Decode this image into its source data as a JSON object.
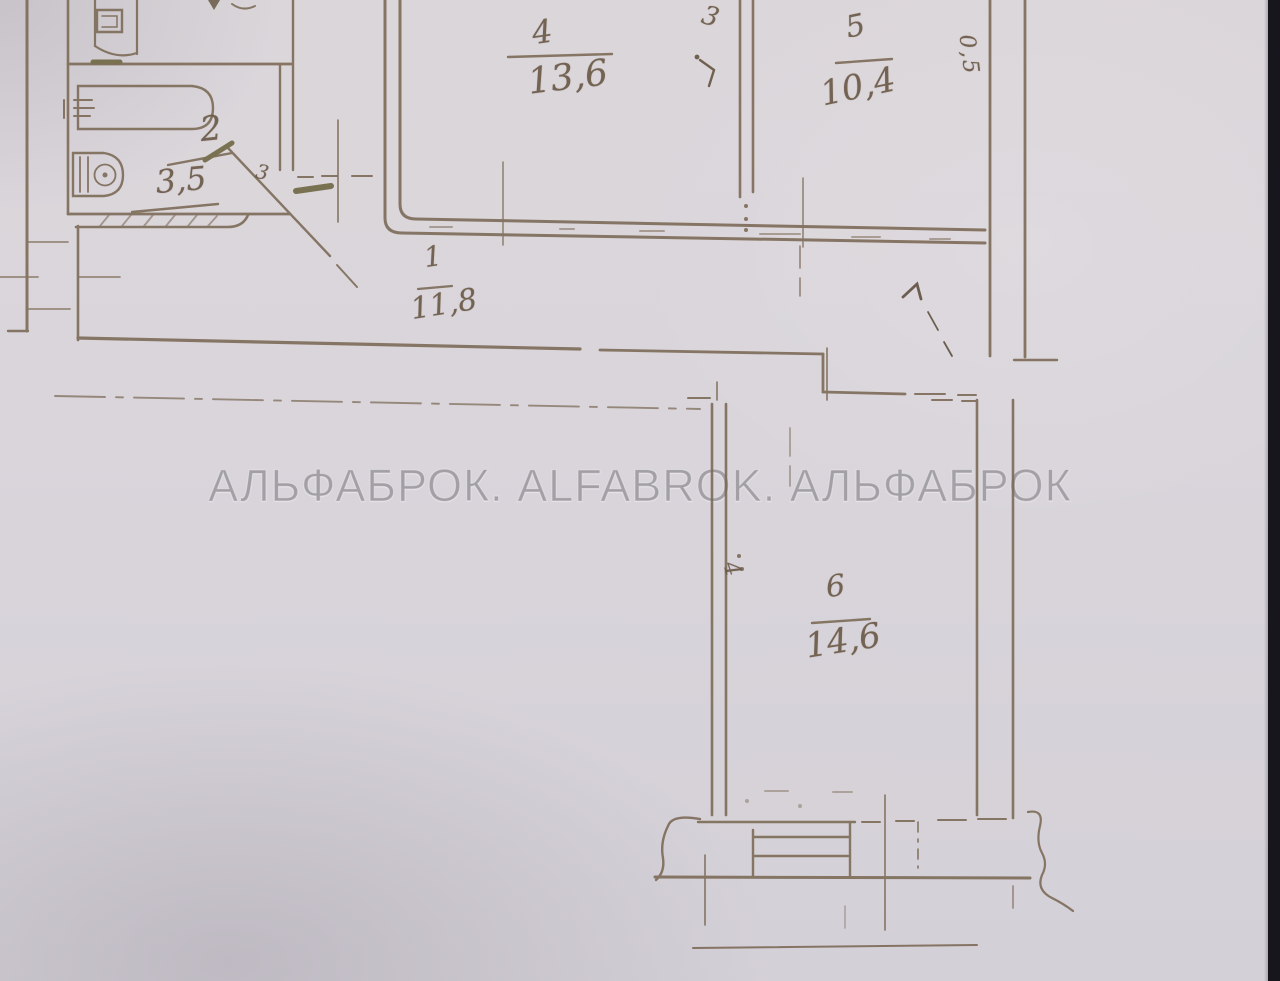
{
  "watermark": {
    "text": "АЛЬФАБРОК. ALFABROK. АЛЬФАБРОК"
  },
  "rooms": {
    "bathroom": {
      "number": "2",
      "area": "3,5"
    },
    "room4": {
      "number": "4",
      "area": "13,6"
    },
    "room5": {
      "number": "5",
      "area": "10,4"
    },
    "corridor": {
      "number": "1",
      "area": "11,8"
    },
    "room6": {
      "number": "6",
      "area": "14,6"
    }
  },
  "annotations": {
    "divider_room_number": "3",
    "bathroom_door_mark": "3",
    "wall_thickness": "0,5",
    "room6_wall_mark": "4"
  },
  "colors": {
    "ink": "#7c6a56",
    "bold_ink": "#6f6742",
    "paper": "#d8d4da",
    "watermark": "#76737a",
    "photo_edge": "#16161c"
  }
}
